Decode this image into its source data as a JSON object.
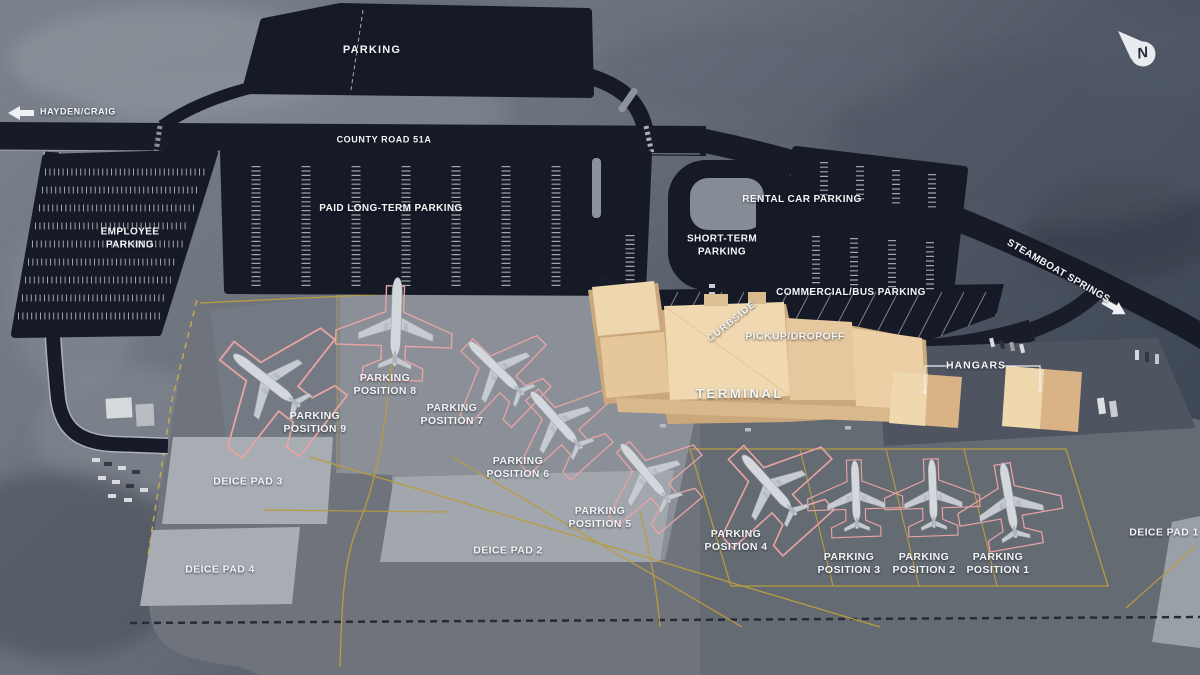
{
  "compass": {
    "north_letter": "N"
  },
  "offsite": {
    "hayden_craig": "HAYDEN/CRAIG",
    "steamboat_springs": "STEAMBOAT SPRINGS",
    "county_road": "COUNTY ROAD 51A"
  },
  "parking": {
    "general": "PARKING",
    "employee": "EMPLOYEE PARKING",
    "paid_long_term": "PAID LONG-TERM PARKING",
    "short_term": "SHORT-TERM PARKING",
    "rental_car": "RENTAL CAR PARKING",
    "commercial_bus": "COMMERCIAL/BUS PARKING"
  },
  "terminal_area": {
    "curbside": "CURBSIDE",
    "pickup_dropoff": "PICKUP/DROPOFF",
    "terminal": "TERMINAL",
    "hangars": "HANGARS"
  },
  "apron": {
    "parking_positions": [
      {
        "id": 1,
        "label": "PARKING POSITION 1"
      },
      {
        "id": 2,
        "label": "PARKING POSITION 2"
      },
      {
        "id": 3,
        "label": "PARKING POSITION 3"
      },
      {
        "id": 4,
        "label": "PARKING POSITION 4"
      },
      {
        "id": 5,
        "label": "PARKING POSITION 5"
      },
      {
        "id": 6,
        "label": "PARKING POSITION 6"
      },
      {
        "id": 7,
        "label": "PARKING POSITION 7"
      },
      {
        "id": 8,
        "label": "PARKING POSITION 8"
      },
      {
        "id": 9,
        "label": "PARKING POSITION 9"
      }
    ],
    "deice_pads": [
      {
        "id": 1,
        "label": "DEICE PAD 1"
      },
      {
        "id": 2,
        "label": "DEICE PAD 2"
      },
      {
        "id": 3,
        "label": "DEICE PAD 3"
      },
      {
        "id": 4,
        "label": "DEICE PAD 4"
      }
    ],
    "aircraft_count": 9
  },
  "colors": {
    "asphalt": "#151a26",
    "apron": "#6e737c",
    "apron_light": "#8b9098",
    "deice_pad": "#a7abb2",
    "building": "#eed6ae",
    "building_shade": "#caa87b",
    "taxi_line": "#b89b42",
    "position_outline": "#e8a3a3",
    "label_text": "#f3f5f7"
  }
}
